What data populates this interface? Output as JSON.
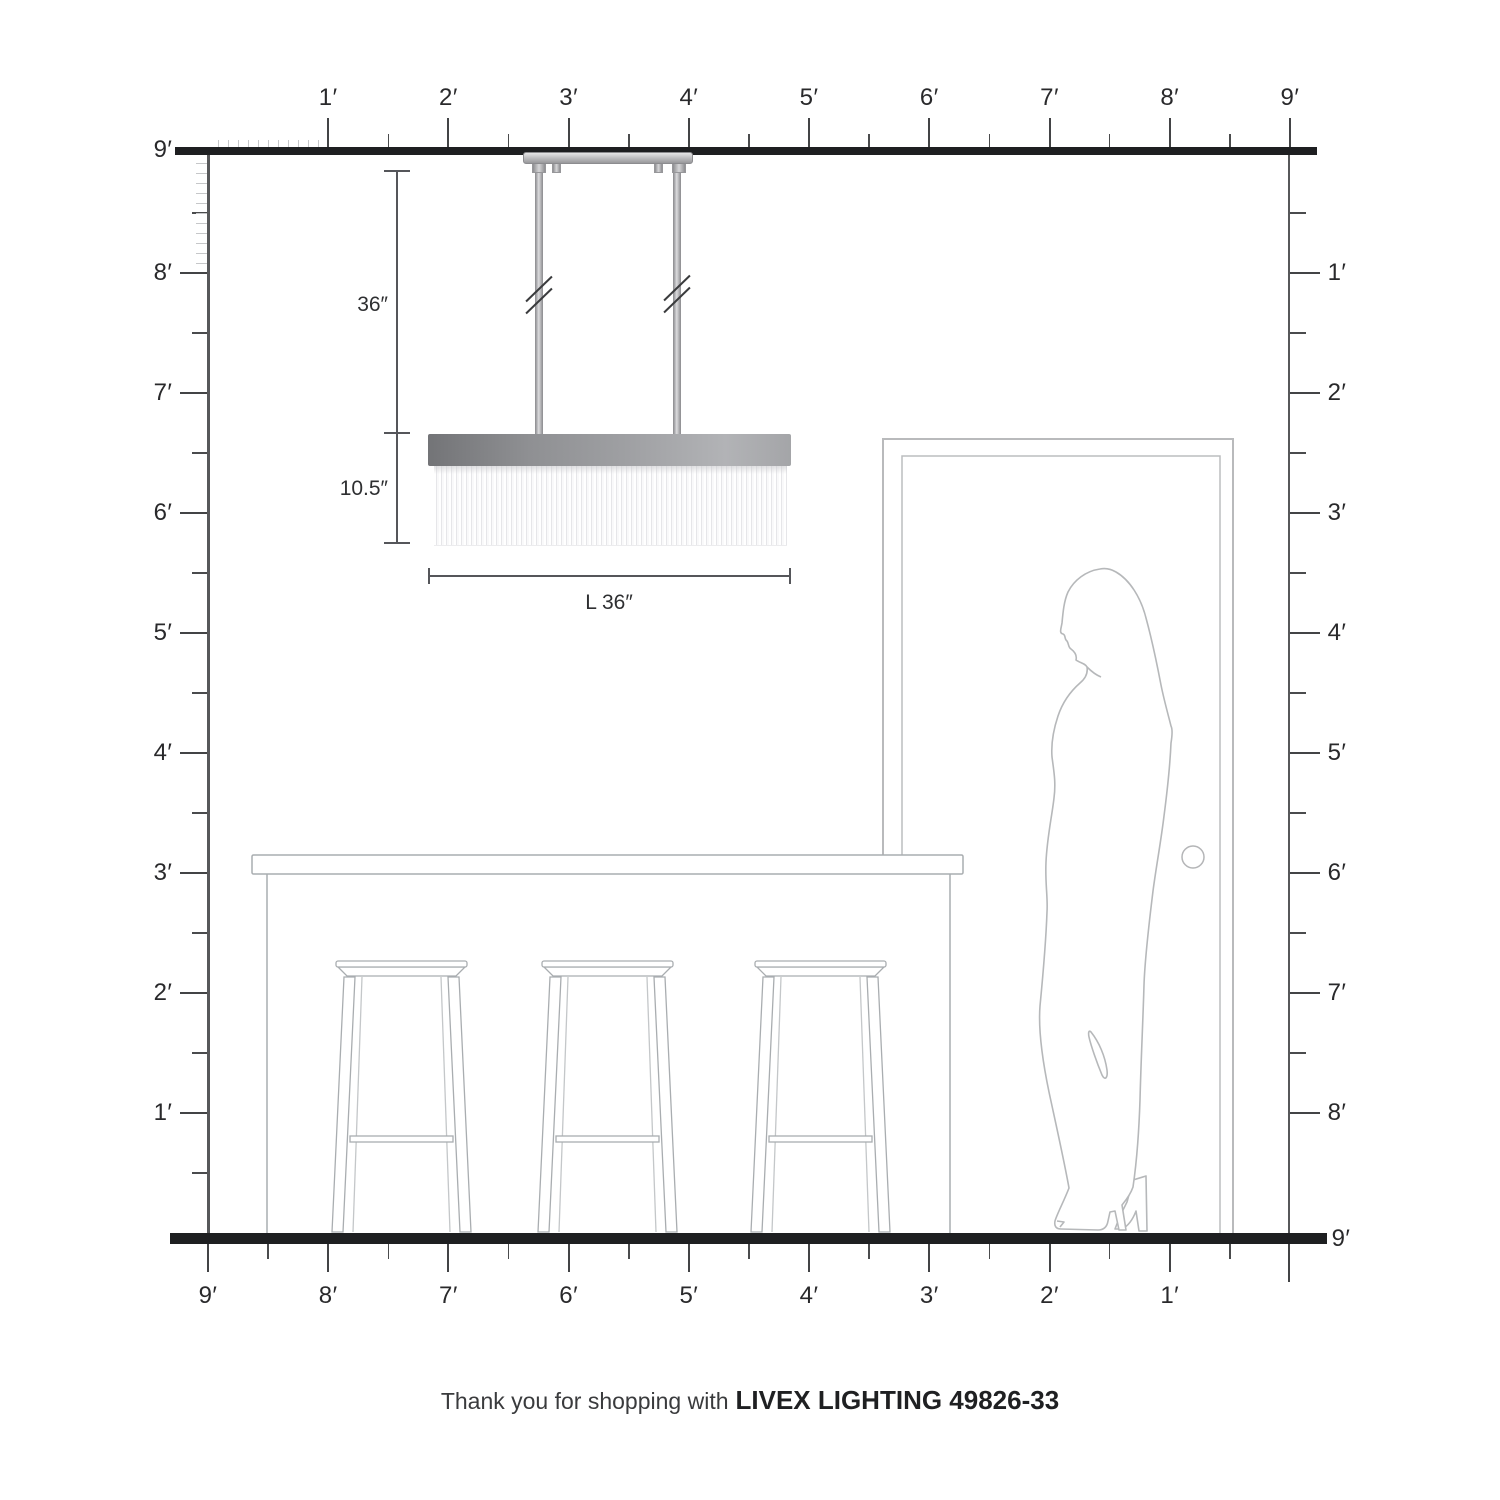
{
  "rulers": {
    "top": {
      "unit_labels": [
        "1′",
        "2′",
        "3′",
        "4′",
        "5′",
        "6′",
        "7′",
        "8′",
        "9′"
      ]
    },
    "left": {
      "unit_labels": [
        "9′",
        "8′",
        "7′",
        "6′",
        "5′",
        "4′",
        "3′",
        "2′",
        "1′"
      ]
    },
    "right": {
      "unit_labels": [
        "1′",
        "2′",
        "3′",
        "4′",
        "5′",
        "6′",
        "7′",
        "8′"
      ],
      "floor_label": "9′"
    },
    "bottom": {
      "unit_labels": [
        "9′",
        "8′",
        "7′",
        "6′",
        "5′",
        "4′",
        "3′",
        "2′",
        "1′"
      ]
    }
  },
  "annotations": {
    "suspension_height": "36″",
    "fixture_height": "10.5″",
    "fixture_length": "L 36″"
  },
  "caption": {
    "prefix": "Thank you for shopping with",
    "brand": "LIVEX LIGHTING 49826-33"
  },
  "scene": {
    "fixture": "linear-crystal-rod-chandelier",
    "stool_count": 3,
    "furniture": [
      "kitchen-island-counter",
      "bar-stools"
    ],
    "door": "door-frame-with-knob",
    "figure": "woman-silhouette"
  },
  "colors": {
    "structure_line": "#1e1f21",
    "ruler_line": "#57585a",
    "tick": "#434446",
    "inch_tick": "#c6c7c9",
    "furniture_outline": "#a9adb0",
    "door_outline": "#b9babc",
    "figure_outline": "#b6b8ba",
    "metal_dark": "#737477",
    "metal_light": "#b2b3b6"
  }
}
